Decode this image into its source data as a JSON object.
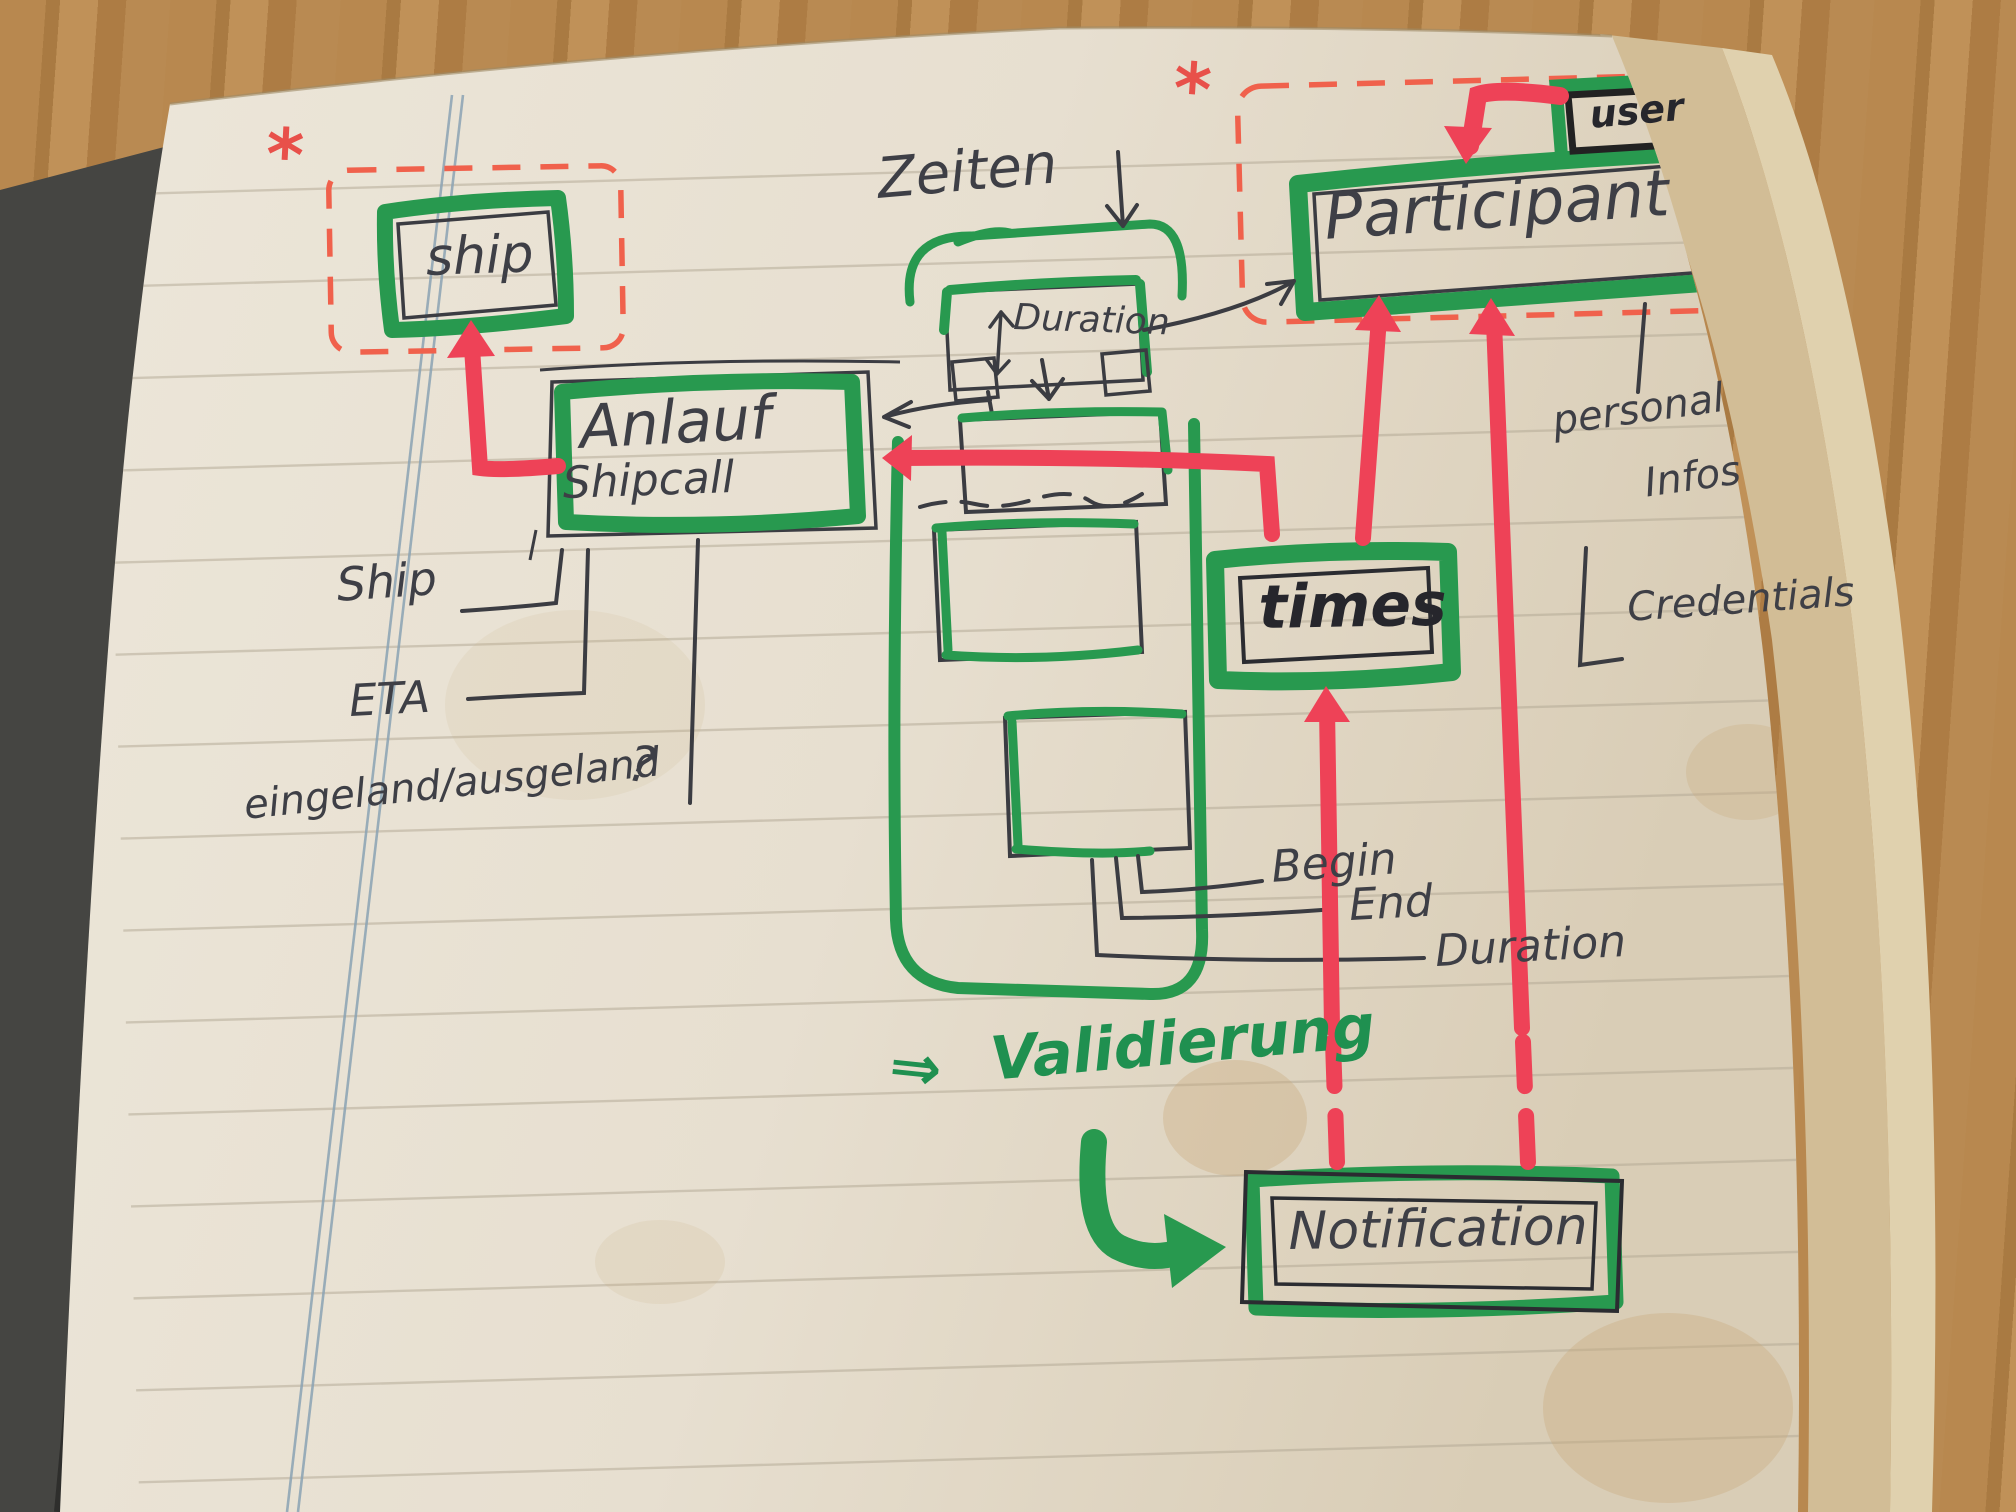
{
  "diagram": {
    "nodes": {
      "ship": {
        "label": "ship"
      },
      "shipcall": {
        "title": "Anlauf",
        "subtitle": "Shipcall"
      },
      "duration_box": {
        "label": "Duration"
      },
      "participant": {
        "label": "Participant"
      },
      "user": {
        "label": "user"
      },
      "times": {
        "label": "times"
      },
      "notification": {
        "label": "Notification"
      }
    },
    "annotations": {
      "zeiten": "Zeiten",
      "zeiten_arrow": "↓",
      "ship_attr": "Ship",
      "eta": "ETA",
      "in_out": "eingeland/ausgeland",
      "question_mark": "?",
      "begin": "Begin",
      "end": "End",
      "duration_attr": "Duration",
      "personal_line1": "personal",
      "personal_line2": "Infos",
      "credentials": "Credentials",
      "validation_arrow": "⇒",
      "validation": "Validierung",
      "asterisk_left": "*",
      "asterisk_right": "*"
    },
    "colors": {
      "marker_green": "#28994f",
      "marker_red": "#ee4257",
      "dashed_red": "#f0614c",
      "pen": "#3b3c42",
      "page": "#e8e1d4"
    }
  }
}
